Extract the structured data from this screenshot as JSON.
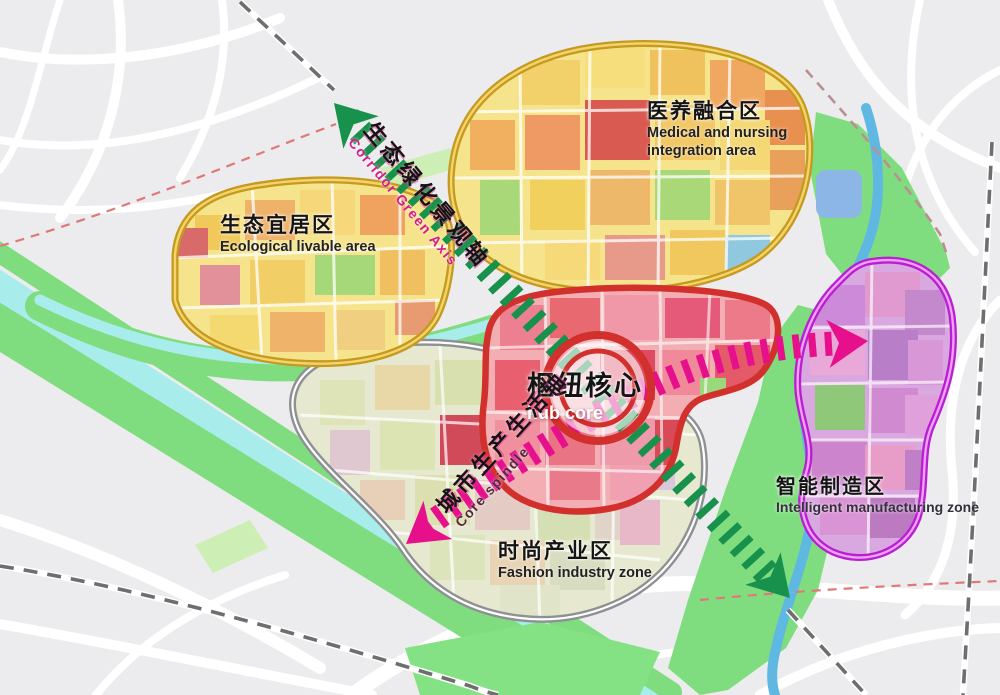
{
  "map_title": "",
  "zones": [
    {
      "id": "ecological",
      "zh": "生态宜居区",
      "en": "Ecological livable area",
      "outline_color": "#c9a427"
    },
    {
      "id": "medical",
      "zh": "医养融合区",
      "en": "Medical and nursing integration area",
      "outline_color": "#c9a427"
    },
    {
      "id": "hub",
      "zh": "枢纽核心",
      "en": "hub core",
      "outline_color": "#d2302c"
    },
    {
      "id": "fashion",
      "zh": "时尚产业区",
      "en": "Fashion industry zone",
      "outline_color": "#8f9093"
    },
    {
      "id": "intelligent",
      "zh": "智能制造区",
      "en": "Intelligent manufacturing zone",
      "outline_color": "#c42fd4"
    }
  ],
  "axes": [
    {
      "id": "green-axis",
      "zh": "生态绿化景观轴",
      "en": "Corridor Green Axis",
      "color": "#17914b",
      "en_color": "#d81b8c"
    },
    {
      "id": "pink-axis",
      "zh": "城市生产生活轴",
      "en": "Core spindle",
      "color": "#e6108c",
      "en_color": "#53293f"
    }
  ],
  "map_colors": {
    "background": "#ececee",
    "road": "#ffffff",
    "green_space": "#7fdd7f",
    "pale_green": "#cdeeb4",
    "river": "#a8ecec",
    "river_deep": "#5fb8e2",
    "lake": "#8cb6e6",
    "yellow_zone_fill": "#f6e48c",
    "hub_fill": "#f2aeb2",
    "fashion_fill": "#e6e9cf",
    "intelligent_fill": "#d9a8e0",
    "railway": "#6e6e6e",
    "boundary_dash": "#e07878",
    "hub_ring": "#d2302c"
  }
}
